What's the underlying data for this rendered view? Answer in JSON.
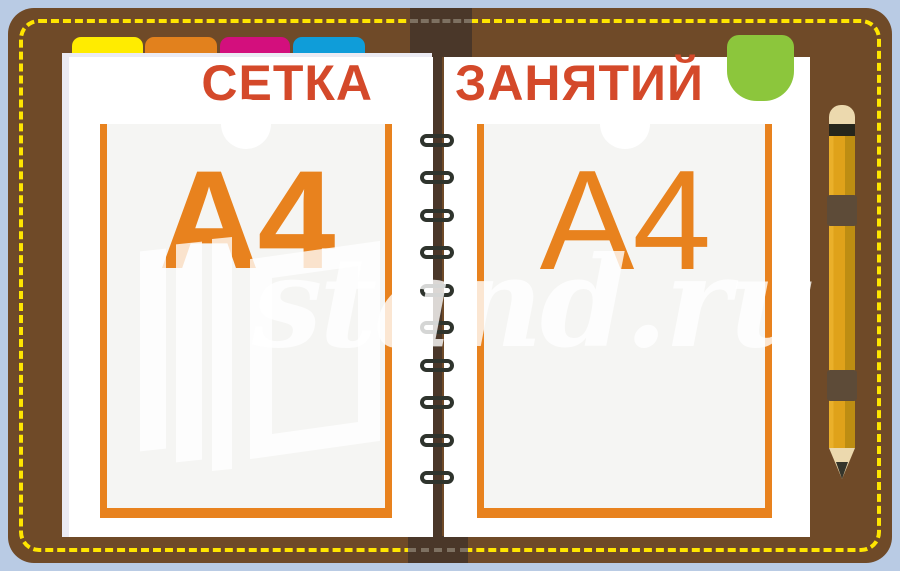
{
  "stand": {
    "title_left": "СЕТКА",
    "title_right": "ЗАНЯТИЙ",
    "pocket_label_left": "А4",
    "pocket_label_right": "А4",
    "watermark_text": "stand.ru"
  },
  "tabs": [
    {
      "name": "yellow",
      "color": "#ffec00"
    },
    {
      "name": "orange",
      "color": "#e2811d"
    },
    {
      "name": "magenta",
      "color": "#d30f7d"
    },
    {
      "name": "blue",
      "color": "#0f9dd9"
    }
  ],
  "colors": {
    "background": "#b9cbe4",
    "cover_brown": "#6f4a28",
    "spine_dark": "#4a3729",
    "stitching_yellow": "#ffe500",
    "title_red": "#d4492a",
    "pocket_orange": "#e8821e",
    "pocket_fill": "#f5f5f3",
    "bookmark_green": "#8cc63c",
    "pencil_yellow": "#dfa21a",
    "page_white": "#ffffff"
  }
}
